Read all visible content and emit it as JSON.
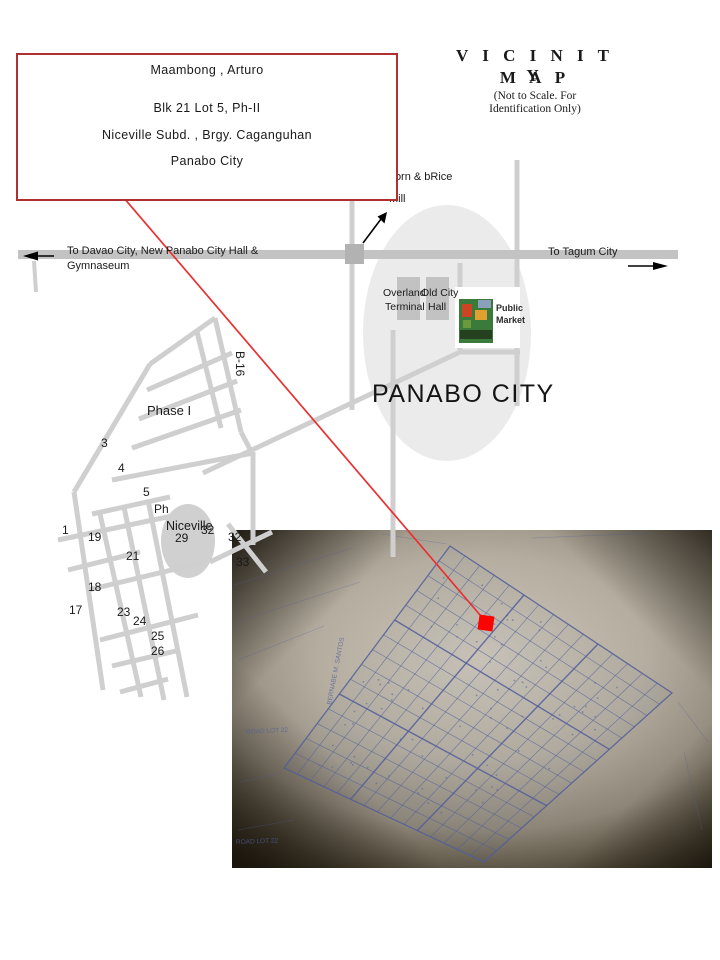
{
  "vicinity_title": {
    "line1": "V I C I N I T Y",
    "line2": "M A P",
    "note1": "(Not to Scale. For",
    "note2": "Identification Only)"
  },
  "owner_box": {
    "name": "Maambong , Arturo",
    "blk_lot": "Blk  21  Lot  5,  Ph-II",
    "subdivision": "Niceville Subd. ,  Brgy. Caganguhan",
    "city": "Panabo City"
  },
  "highway": {
    "west_line1": "To Davao City, New Panabo City Hall &",
    "west_line2": "Gymnaseum",
    "east": "To Tagum City"
  },
  "landmarks": {
    "mill_line1": "Corn & bRice",
    "mill_line2": "Mill",
    "terminal_line1": "Overland",
    "terminal_line2": "Terminal",
    "old_hall_line1": "Old City",
    "old_hall_line2": "Hall",
    "market_line1": "Public",
    "market_line2": "Market"
  },
  "map_labels": {
    "city_name": "PANABO CITY",
    "phase1": "Phase I",
    "phase2": "Ph",
    "subd_name": "Niceville",
    "road": "B-16"
  },
  "block_numbers": [
    {
      "n": "3",
      "x": 101,
      "y": 436
    },
    {
      "n": "4",
      "x": 118,
      "y": 461
    },
    {
      "n": "5",
      "x": 143,
      "y": 485
    },
    {
      "n": "1",
      "x": 62,
      "y": 523
    },
    {
      "n": "19",
      "x": 88,
      "y": 530
    },
    {
      "n": "29",
      "x": 175,
      "y": 531
    },
    {
      "n": "32",
      "x": 201,
      "y": 523
    },
    {
      "n": "32",
      "x": 228,
      "y": 530
    },
    {
      "n": "33",
      "x": 236,
      "y": 555
    },
    {
      "n": "21",
      "x": 126,
      "y": 549
    },
    {
      "n": "18",
      "x": 88,
      "y": 580
    },
    {
      "n": "17",
      "x": 69,
      "y": 603
    },
    {
      "n": "23",
      "x": 117,
      "y": 605
    },
    {
      "n": "24",
      "x": 133,
      "y": 614
    },
    {
      "n": "25",
      "x": 151,
      "y": 629
    },
    {
      "n": "26",
      "x": 151,
      "y": 644
    }
  ],
  "site_plan": {
    "marker_color": "#fb0400",
    "labels": [
      {
        "t": "ROAD LOT 22",
        "x": 14,
        "y": 204,
        "r": -3
      },
      {
        "t": "ROAD LOT 22",
        "x": 4,
        "y": 314,
        "r": -2
      },
      {
        "t": "BERNABE M. SANTOS",
        "x": 99,
        "y": 175,
        "r": -79
      }
    ]
  },
  "colors": {
    "accent_red": "#b03030",
    "leader_red": "#e93030",
    "road_gray": "#cfcfcf",
    "highway_gray": "#c3c3c3",
    "ellipse_gray": "#ebebeb",
    "ink_blue": "#515e9b"
  }
}
